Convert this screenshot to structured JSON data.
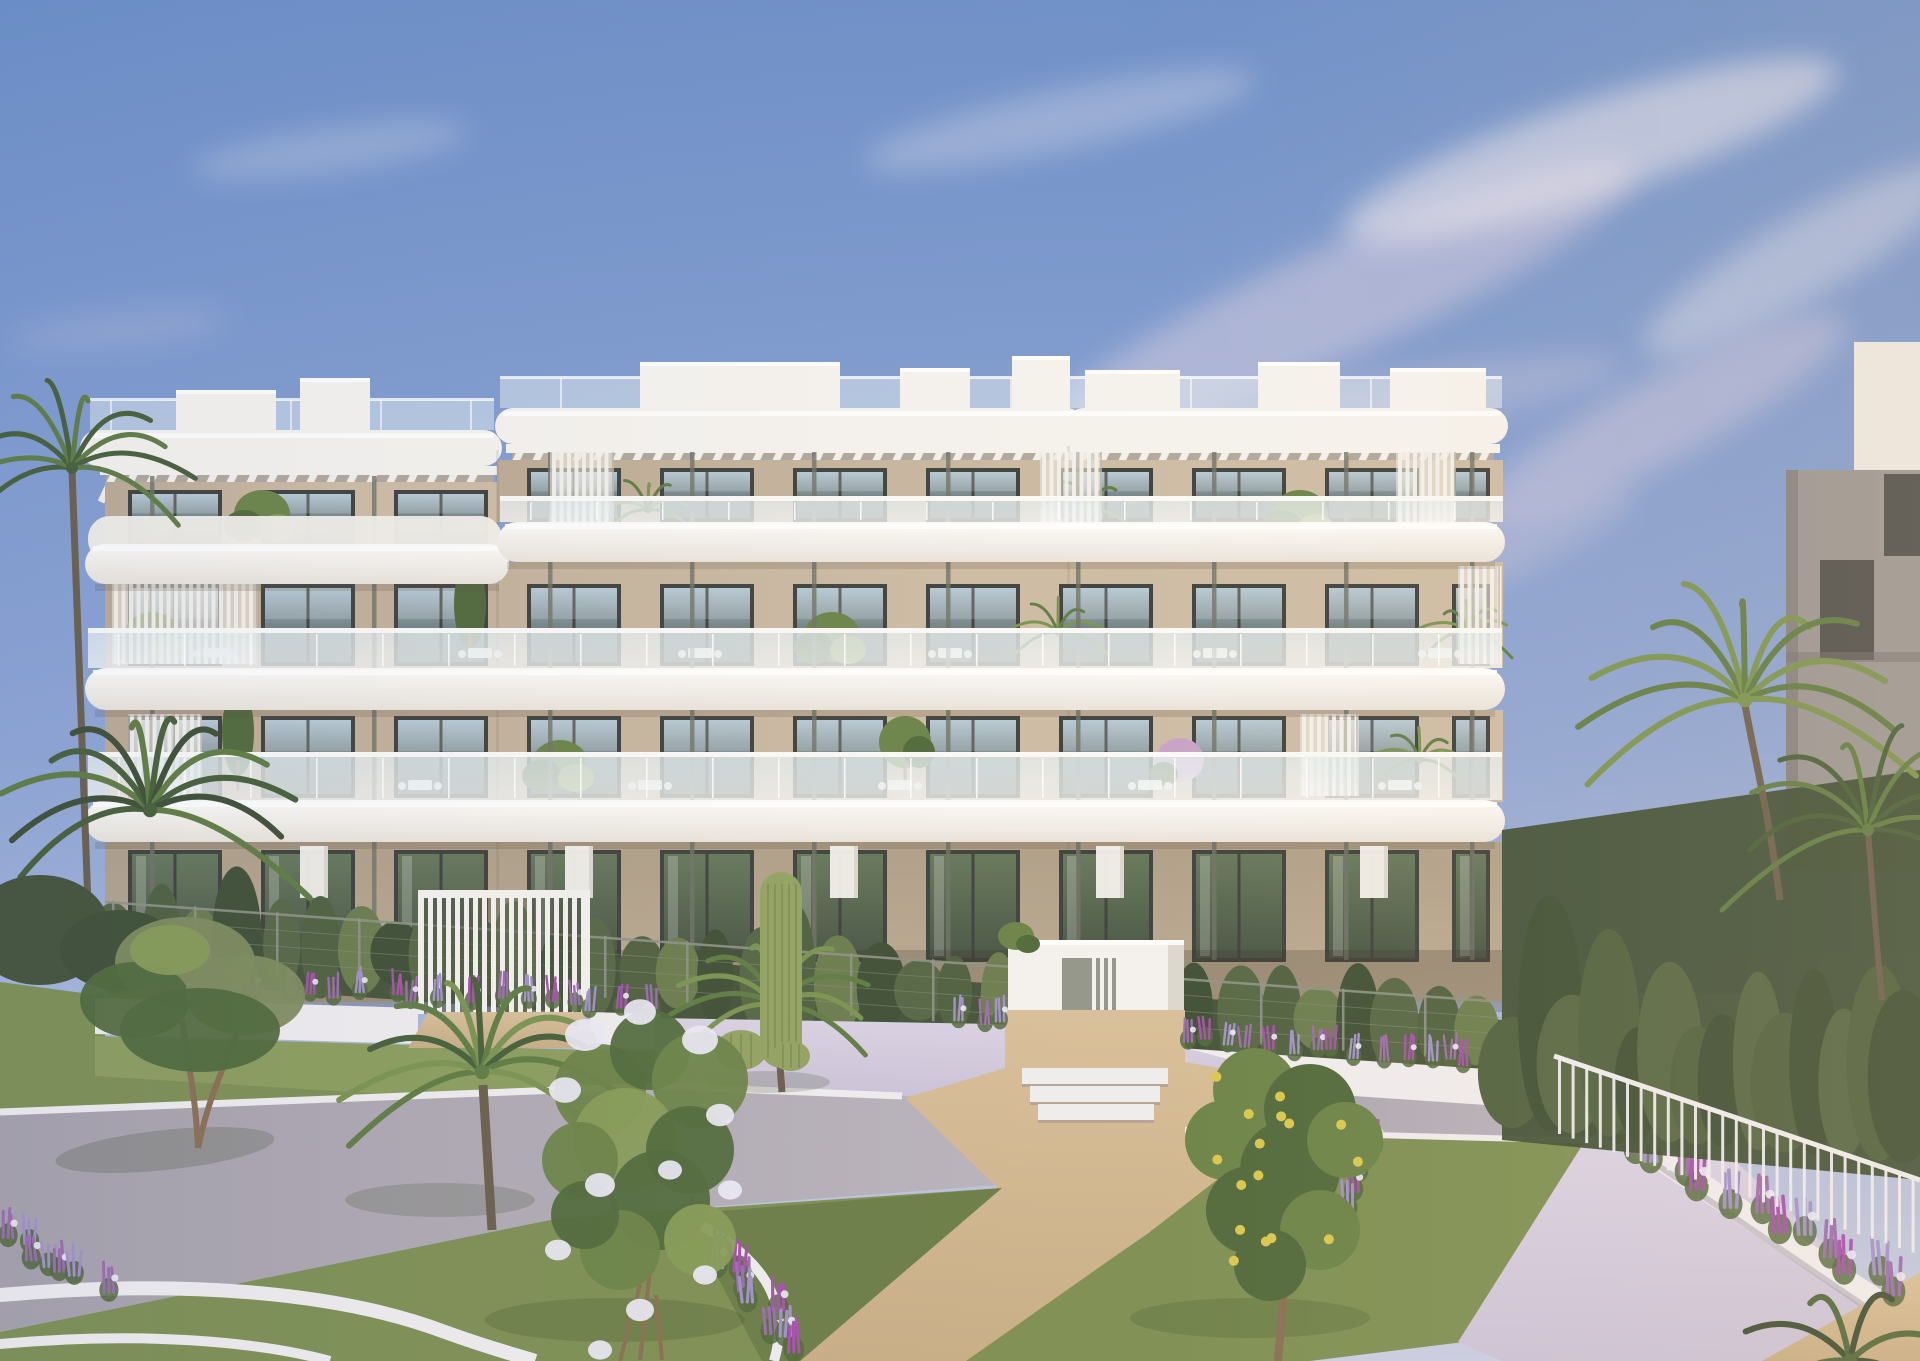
{
  "meta": {
    "domain": "Natural-Image",
    "type": "3d-architectural-exterior-render",
    "description": "Exterior render of a modern four-storey apartment building with curved white balcony slabs, glass balustrades, rooftop pergola louvres and beige walls, behind a white fence with cypress hedge and entrance gates, fronted by a landscaped Mediterranean garden with lawns, tan gravel and concrete paths, lilac gravel beds, purple and white flowers, an olive tree, fan palms, cacti, a lemon tree and a white flowering shrub, under a blue sky with wispy pink clouds at golden hour.",
    "visible_text": []
  },
  "building": {
    "storeys": 4,
    "sections": 3,
    "window_columns": 11,
    "entrance_gates": 3,
    "balcony_style": "glass balustrade",
    "roof": "white pergola louvres"
  },
  "garden": {
    "features": [
      "lawns",
      "concrete path",
      "tan gravel paths",
      "lilac gravel",
      "white planter walls",
      "flower beds",
      "white metal railing",
      "cypress grove",
      "palm trees",
      "olive tree",
      "saguaro cactus",
      "lemon tree",
      "white flowering shrub"
    ]
  },
  "palette": {
    "skyTop": "#6C8FC9",
    "skyMid": "#8FA6D5",
    "skyHorizon": "#C9CEE4",
    "cloudPink": "#D9CFE3",
    "cloudWhite": "#EFEAF2",
    "fasciaWhite": "#F5F3EF",
    "slabTop": "#FDFCFA",
    "slabBot": "#E9E4DC",
    "wallLit": "#CDBCA5",
    "wallShade": "#BCAB94",
    "wallGround": "#AFA089",
    "pergolaGap": "#B3A898",
    "frameDark": "#3E423E",
    "winTop": "#A9BFCC",
    "winMid": "#76868A",
    "winBot": "#5A6760",
    "gGlassTop": "#66785C",
    "gGlassBot": "#485545",
    "balGlassTop": "#E8F0F2",
    "balGlassBot": "#F6F8F8",
    "balRail": "#FAFAF8",
    "louverWhite": "#F3F1EC",
    "postGray": "#6F7368",
    "hedgeDark": "#45543A",
    "hedgeMid": "#566745",
    "hedgeLight": "#6B7D4E",
    "cypress": "#4F6140",
    "cypressDark": "#3F5036",
    "fenceGray": "#8E9386",
    "gateWhite": "#F4F2EE",
    "gateShade": "#DCD8D0",
    "lawn": "#7E9054",
    "lawnLight": "#8C9E5E",
    "lawnShade": "#6C7E48",
    "pathTan": "#C8AE87",
    "pathTanLight": "#D8C09A",
    "gravelLilac": "#CBC3D8",
    "gravelLight": "#DAD3E5",
    "concrete": "#A7A2AC",
    "concreteLight": "#BCB6C0",
    "curbWhite": "#EFEDEF",
    "flowerPurple": "#9C6CB0",
    "flowerMagenta": "#A84FB0",
    "flowerLavender": "#A291CC",
    "flowerWhite": "#ECEAF6",
    "leafGreen": "#6B8448",
    "leafDark": "#516A3C",
    "leafLight": "#879C57",
    "oliveLeaf": "#7E8C5E",
    "trunkBrown": "#8A6F52",
    "palmGreen": "#5F7D44",
    "palmDark": "#47603A",
    "palmLight": "#7A9451",
    "cactusGreen": "#93A463",
    "cactusDark": "#7C8C50",
    "lemonYellow": "#D9C84E",
    "neighborGray": "#9A9795",
    "neighborDark": "#757271",
    "neighborWindow": "#4F504E",
    "farWhite": "#ECE9E4"
  }
}
